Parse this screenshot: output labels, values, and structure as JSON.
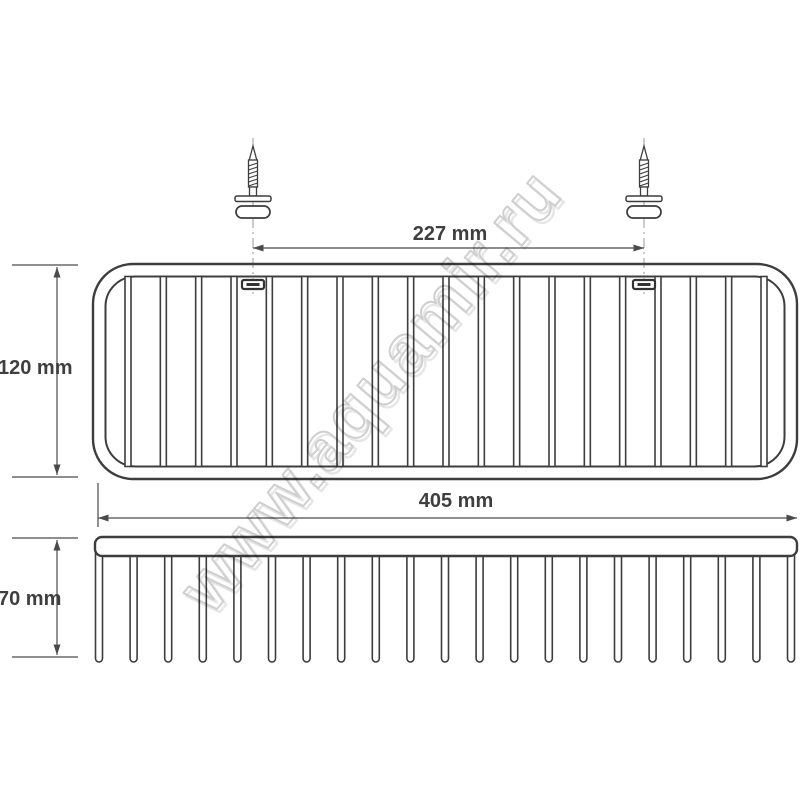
{
  "drawing": {
    "title": "wire-basket-dimension-drawing",
    "watermark": {
      "text": "www.aquamir.ru"
    },
    "dimensions": {
      "mount_spacing": {
        "label": "227 mm"
      },
      "basket_height": {
        "label": "120 mm"
      },
      "basket_width": {
        "label": "405 mm"
      },
      "basket_depth": {
        "label": "70 mm"
      }
    },
    "views": {
      "top": {
        "bar_count": 19,
        "mount_tab_count": 2
      },
      "side": {
        "wire_count": 21
      },
      "screw_count": 2
    },
    "colors": {
      "line": "#3d3d3d",
      "dimension_line": "#555555",
      "centerline": "#9a9a9a",
      "text": "#3f3f3f",
      "watermark_stroke": "#cfcfcf",
      "background": "#ffffff"
    }
  }
}
